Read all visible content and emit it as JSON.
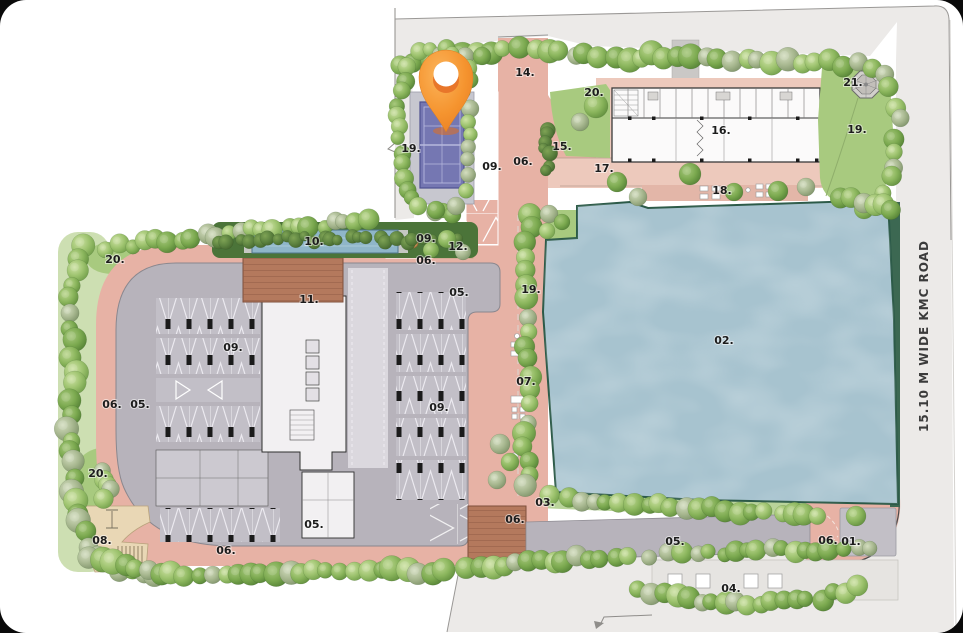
{
  "site_plan": {
    "road_label": "15.10 M WIDE KMC ROAD",
    "markers": [
      {
        "text": "01.",
        "x": 851,
        "y": 545
      },
      {
        "text": "02.",
        "x": 724,
        "y": 344
      },
      {
        "text": "03.",
        "x": 545,
        "y": 506
      },
      {
        "text": "04.",
        "x": 731,
        "y": 592
      },
      {
        "text": "05.",
        "x": 140,
        "y": 408
      },
      {
        "text": "05.",
        "x": 459,
        "y": 296
      },
      {
        "text": "05.",
        "x": 314,
        "y": 528
      },
      {
        "text": "05.",
        "x": 675,
        "y": 545
      },
      {
        "text": "06.",
        "x": 523,
        "y": 165
      },
      {
        "text": "06.",
        "x": 426,
        "y": 264
      },
      {
        "text": "06.",
        "x": 112,
        "y": 408
      },
      {
        "text": "06.",
        "x": 226,
        "y": 554
      },
      {
        "text": "06.",
        "x": 515,
        "y": 523
      },
      {
        "text": "06.",
        "x": 828,
        "y": 544
      },
      {
        "text": "07.",
        "x": 526,
        "y": 385
      },
      {
        "text": "08.",
        "x": 102,
        "y": 544
      },
      {
        "text": "09.",
        "x": 492,
        "y": 170
      },
      {
        "text": "09.",
        "x": 426,
        "y": 242
      },
      {
        "text": "09.",
        "x": 233,
        "y": 351
      },
      {
        "text": "09.",
        "x": 439,
        "y": 411
      },
      {
        "text": "10.",
        "x": 314,
        "y": 245
      },
      {
        "text": "11.",
        "x": 309,
        "y": 303
      },
      {
        "text": "12.",
        "x": 458,
        "y": 250
      },
      {
        "text": "14.",
        "x": 525,
        "y": 76
      },
      {
        "text": "15.",
        "x": 562,
        "y": 150
      },
      {
        "text": "16.",
        "x": 721,
        "y": 134
      },
      {
        "text": "17.",
        "x": 604,
        "y": 172
      },
      {
        "text": "18.",
        "x": 722,
        "y": 194
      },
      {
        "text": "19.",
        "x": 411,
        "y": 152
      },
      {
        "text": "19.",
        "x": 857,
        "y": 133
      },
      {
        "text": "19.",
        "x": 531,
        "y": 293
      },
      {
        "text": "20.",
        "x": 594,
        "y": 96
      },
      {
        "text": "20.",
        "x": 115,
        "y": 263
      },
      {
        "text": "20.",
        "x": 98,
        "y": 477
      },
      {
        "text": "21.",
        "x": 853,
        "y": 86
      }
    ]
  },
  "colors": {
    "outside_area": "#eceae8",
    "road": "#e7b2a5",
    "road_light": "#edc9bc",
    "deck": "#e3b6a8",
    "podium": "#b7b3bb",
    "strip_podium": "#b7b3bb",
    "water": "#a7c3cf",
    "water_edge": "#2c5a48",
    "lawn": "#a8ca7f",
    "green_strip": "#b9d49a",
    "hedge": "#4b7439",
    "court": "#7577b2",
    "ramp": "#b4795d",
    "pad": "#e9d7b5",
    "entry_pad": "#c2bfc6",
    "pin": "#f79f3e"
  }
}
